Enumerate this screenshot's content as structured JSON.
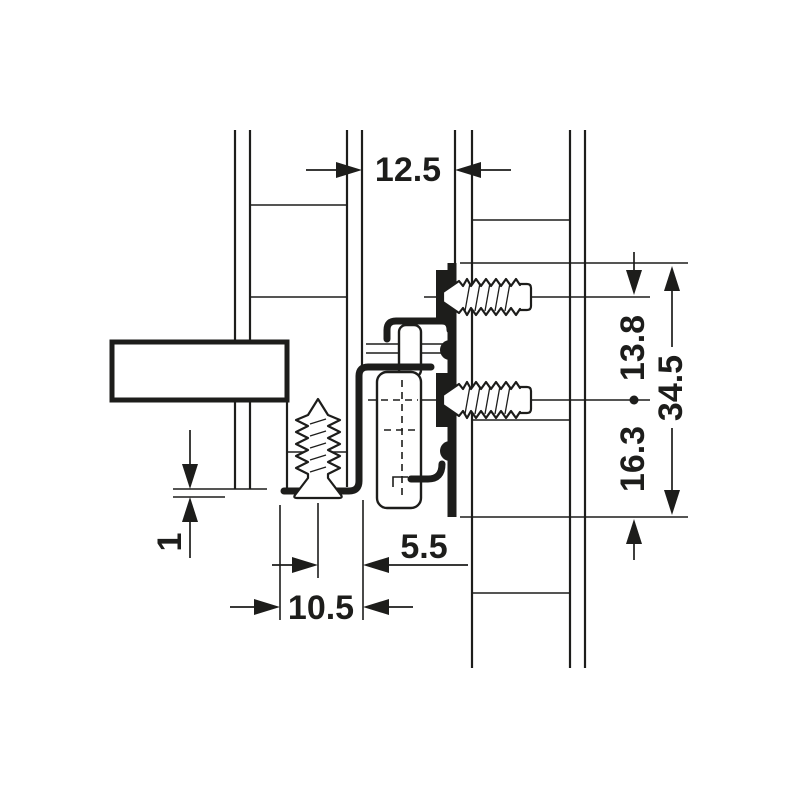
{
  "diagram": {
    "kind": "technical-drawing",
    "dimensions": {
      "panel_gap": "12.5",
      "upper_hole_spacing": "13.8",
      "runner_total_height": "34.5",
      "lower_hole_to_bottom": "16.3",
      "screw_axis_to_edge": "5.5",
      "flange_width": "10.5",
      "bottom_clearance": "1"
    },
    "colors": {
      "ink": "#1d1d1b",
      "paper": "#ffffff"
    }
  }
}
